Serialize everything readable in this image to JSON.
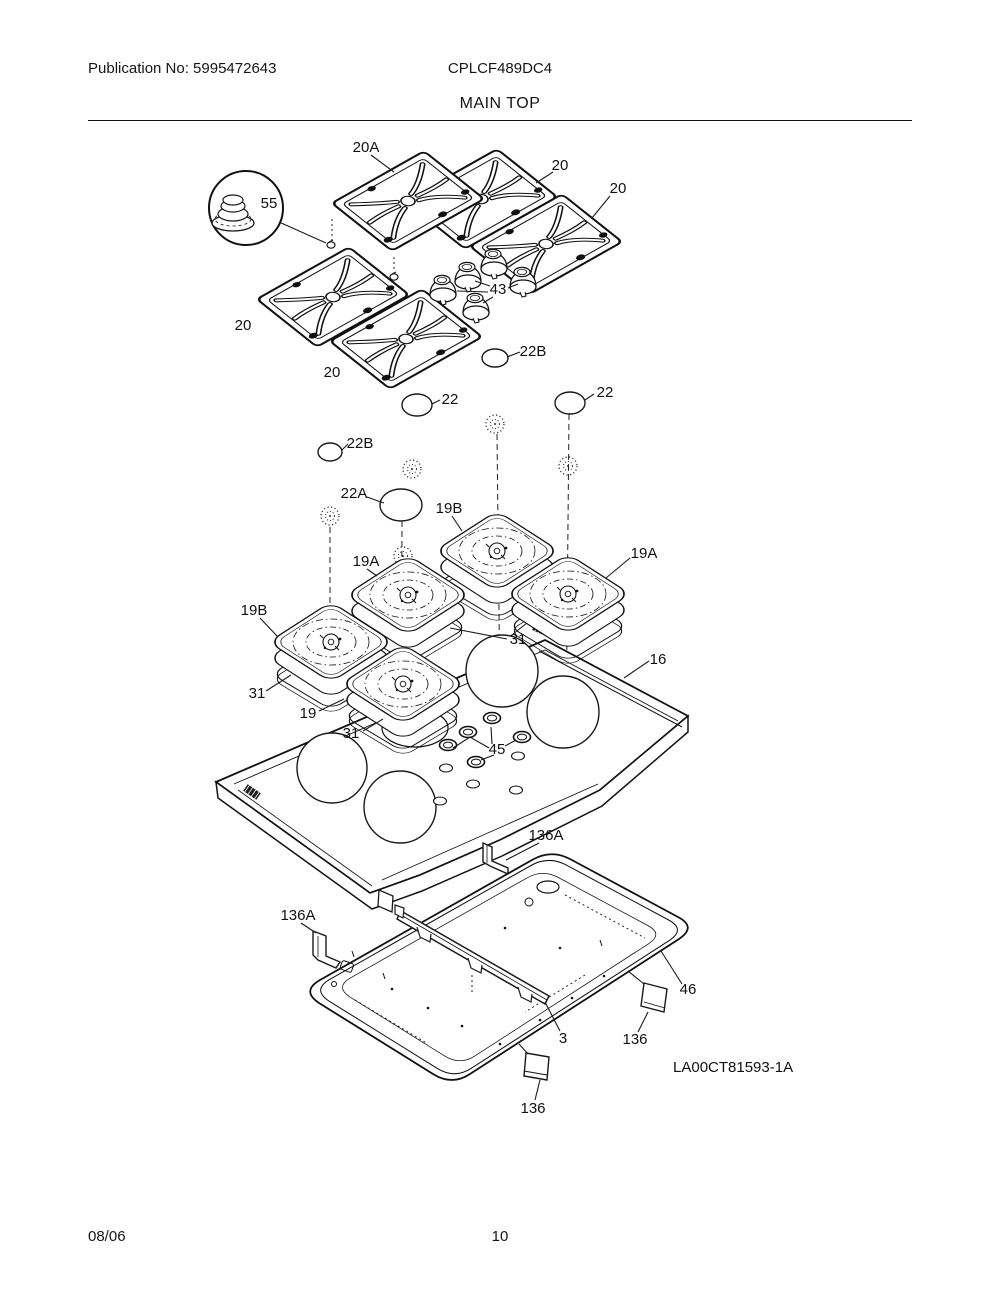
{
  "page": {
    "publication_no": "Publication No: 5995472643",
    "model": "CPLCF489DC4",
    "section_title": "MAIN TOP",
    "footer_date": "08/06",
    "footer_page": "10"
  },
  "diagram": {
    "description": "Exploded view of gas cooktop main top assembly",
    "diagram_code": "LA00CT81593-1A",
    "callouts": [
      "20A",
      "20",
      "20",
      "55",
      "43",
      "20",
      "20",
      "22B",
      "22",
      "22",
      "22B",
      "22A",
      "19B",
      "19A",
      "19A",
      "19B",
      "31",
      "16",
      "31",
      "19",
      "31",
      "45",
      "136A",
      "136A",
      "46",
      "3",
      "136",
      "136"
    ]
  }
}
